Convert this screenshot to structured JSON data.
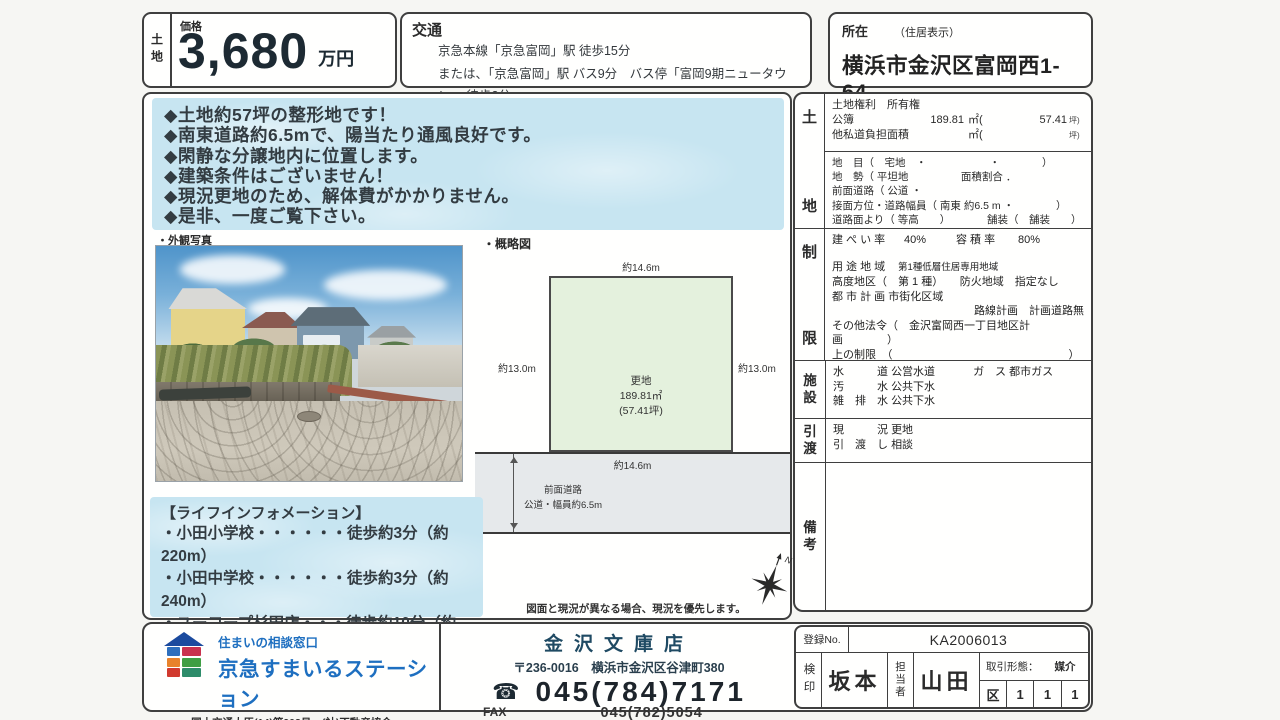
{
  "colors": {
    "brand_blue": "#1e6fc0",
    "store_navy": "#1f4a63",
    "panel_blue": "#c7e5f1",
    "plot_green": "#e4f1dd",
    "road_gray": "#e6e9eb",
    "border_dark": "#3f3f3f"
  },
  "header": {
    "category": "土地",
    "price_label": "価格",
    "price_value": "3,680",
    "price_unit": "万円",
    "access_label": "交通",
    "access_line1": "京急本線「京急富岡」駅 徒歩15分",
    "access_line2": "または、「京急富岡」駅 バス9分　バス停「富岡9期ニュータウン」 徒歩2分",
    "location_label": "所在",
    "location_sublabel": "（住居表示）",
    "location_value": "横浜市金沢区富岡西1-64"
  },
  "features": {
    "items": [
      "◆土地約57坪の整形地です！",
      "◆南東道路約6.5mで、陽当たり通風良好です。",
      "◆閑静な分譲地内に位置します。",
      "◆建築条件はございません！",
      "◆現況更地のため、解体費がかかりません。",
      "◆是非、一度ご覧下さい。"
    ]
  },
  "photo": {
    "caption": "・外観写真"
  },
  "diagram": {
    "caption": "・概略図",
    "dim_top": "約14.6m",
    "dim_left": "約13.0m",
    "dim_right": "約13.0m",
    "dim_bottom": "約14.6m",
    "plot_line1": "更地",
    "plot_line2": "189.81㎡",
    "plot_line3": "(57.41坪)",
    "road_line1": "前面道路",
    "road_line2": "公道・幅員約6.5m",
    "compass_n": "N",
    "note": "図面と現況が異なる場合、現況を優先します。"
  },
  "life_info": {
    "title": "【ライフインフォメーション】",
    "items": [
      "・小田小学校・・・・・・徒歩約3分（約220m）",
      "・小田中学校・・・・・・徒歩約3分（約240m）",
      "・ユーコープ杉田店・・・徒歩約10分（約780m）",
      "・富岡公園・・・・・・・徒歩約2分（約150m）"
    ]
  },
  "details": {
    "land_label_1": "土",
    "land_label_2": "地",
    "rights": "土地権利　所有権",
    "koubo_label": "公簿",
    "koubo_value": "189.81",
    "koubo_unit": "㎡(",
    "koubo_tsubo": "57.41",
    "tsubo_unit": "坪)",
    "private_road_label": "他私道負担面積",
    "private_road_unit": "㎡(",
    "private_road_tsubo_unit": "坪)",
    "chimoku": "地　目（　宅地　・　　　　　　・　　　　）",
    "chisei": "地　勢（ 平坦地　　　　　面積割合 ．",
    "front_road": "前面道路（ 公道 ・",
    "setsumen": "接面方位・道路幅員（ 南東 約6.5 m ・　　　　）",
    "road_level": "道路面より（ 等高　　）　　　　舗装（　舗装　　）",
    "restrict_label_1": "制",
    "restrict_label_2": "限",
    "kenpei_label": "建 ぺ い 率",
    "kenpei_value": "40%",
    "yoseki_label": "容 積 率",
    "yoseki_value": "80%",
    "yoto_label": "用 途 地 域",
    "yoto_value": "第1種低層住居専用地域",
    "koudo": "高度地区（　第 1 種）　　防火地域　指定なし",
    "toshi": "都 市 計 画 市街化区域",
    "rosen": "路線計画　計画道路無",
    "other_law1": "その他法令（　金沢富岡西一丁目地区計画　　　　）",
    "other_law2": "上の制限　（　　　　　　　　　　　　　　　　）",
    "facility_label_1": "施",
    "facility_label_2": "設",
    "water_label": "水　　　道",
    "water_value": "公営水道",
    "gas_label": "ガ　ス",
    "gas_value": "都市ガス",
    "sewage_label": "汚　　　水",
    "sewage_value": "公共下水",
    "drain_label": "雑　排　水",
    "drain_value": "公共下水",
    "handover_label_1": "引",
    "handover_label_2": "渡",
    "genkyo_label": "現　　　況",
    "genkyo_value": "更地",
    "hikiwatashi_label": "引　渡　し",
    "hikiwatashi_value": "相談",
    "remarks_label_1": "備",
    "remarks_label_2": "考"
  },
  "footer": {
    "tagline": "住まいの相談窓口",
    "brand": "京急すまいるステーション",
    "license1": "国土交通大臣(14)第902号　(社)不動産協会",
    "license2": "(公社)首都圏不動産公正取引協議会加盟 (社)不動産流通経営協会",
    "store_name": "金沢文庫店",
    "store_address": "〒236-0016　横浜市金沢区谷津町380",
    "phone_icon": "☎",
    "phone": "045(784)7171",
    "fax_label": "FAX",
    "fax": "045(782)5054",
    "reg_label": "登録No.",
    "reg_value": "KA2006013",
    "kenin_label": "検印",
    "kenin_value": "坂本",
    "tanto_label": "担当者",
    "tanto_value": "山田",
    "torihiki_label": "取引形態：",
    "torihiki_value": "媒介",
    "grid_1": "区",
    "grid_2": "1",
    "grid_3": "1",
    "grid_4": "1"
  }
}
